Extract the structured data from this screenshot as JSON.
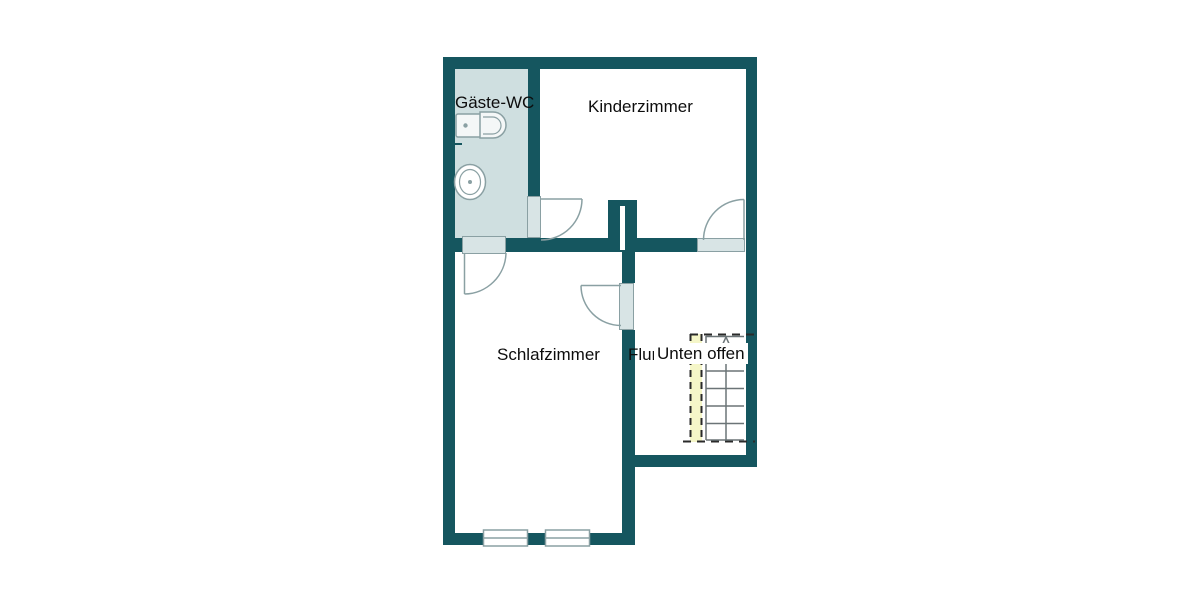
{
  "type": "floor-plan",
  "colors": {
    "background": "#ffffff",
    "wall": "#15565f",
    "wc_floor": "#cfdfe0",
    "door_fill": "#d8e4e5",
    "outline_gray": "#8aa0a3",
    "fixture_fill": "#f4f7f7",
    "stair_line": "#6b7477",
    "stair_dash": "#2a2a2a",
    "stair_strip": "#f5f6c8",
    "text": "#0d0d0d"
  },
  "rooms": [
    {
      "id": "gaeste-wc",
      "label": "Gäste-WC"
    },
    {
      "id": "kinderzimmer",
      "label": "Kinderzimmer"
    },
    {
      "id": "schlafzimmer",
      "label": "Schlafzimmer"
    },
    {
      "id": "flur",
      "label": "Flur"
    }
  ],
  "annotations": [
    {
      "id": "unten-offen",
      "label": "Unten offen"
    }
  ],
  "fixtures": {
    "toilet": "toilet-icon",
    "sink": "washbasin-icon",
    "stairs": {
      "name": "staircase",
      "direction": "up",
      "steps": 6
    },
    "windows": 2,
    "doors": 4
  }
}
